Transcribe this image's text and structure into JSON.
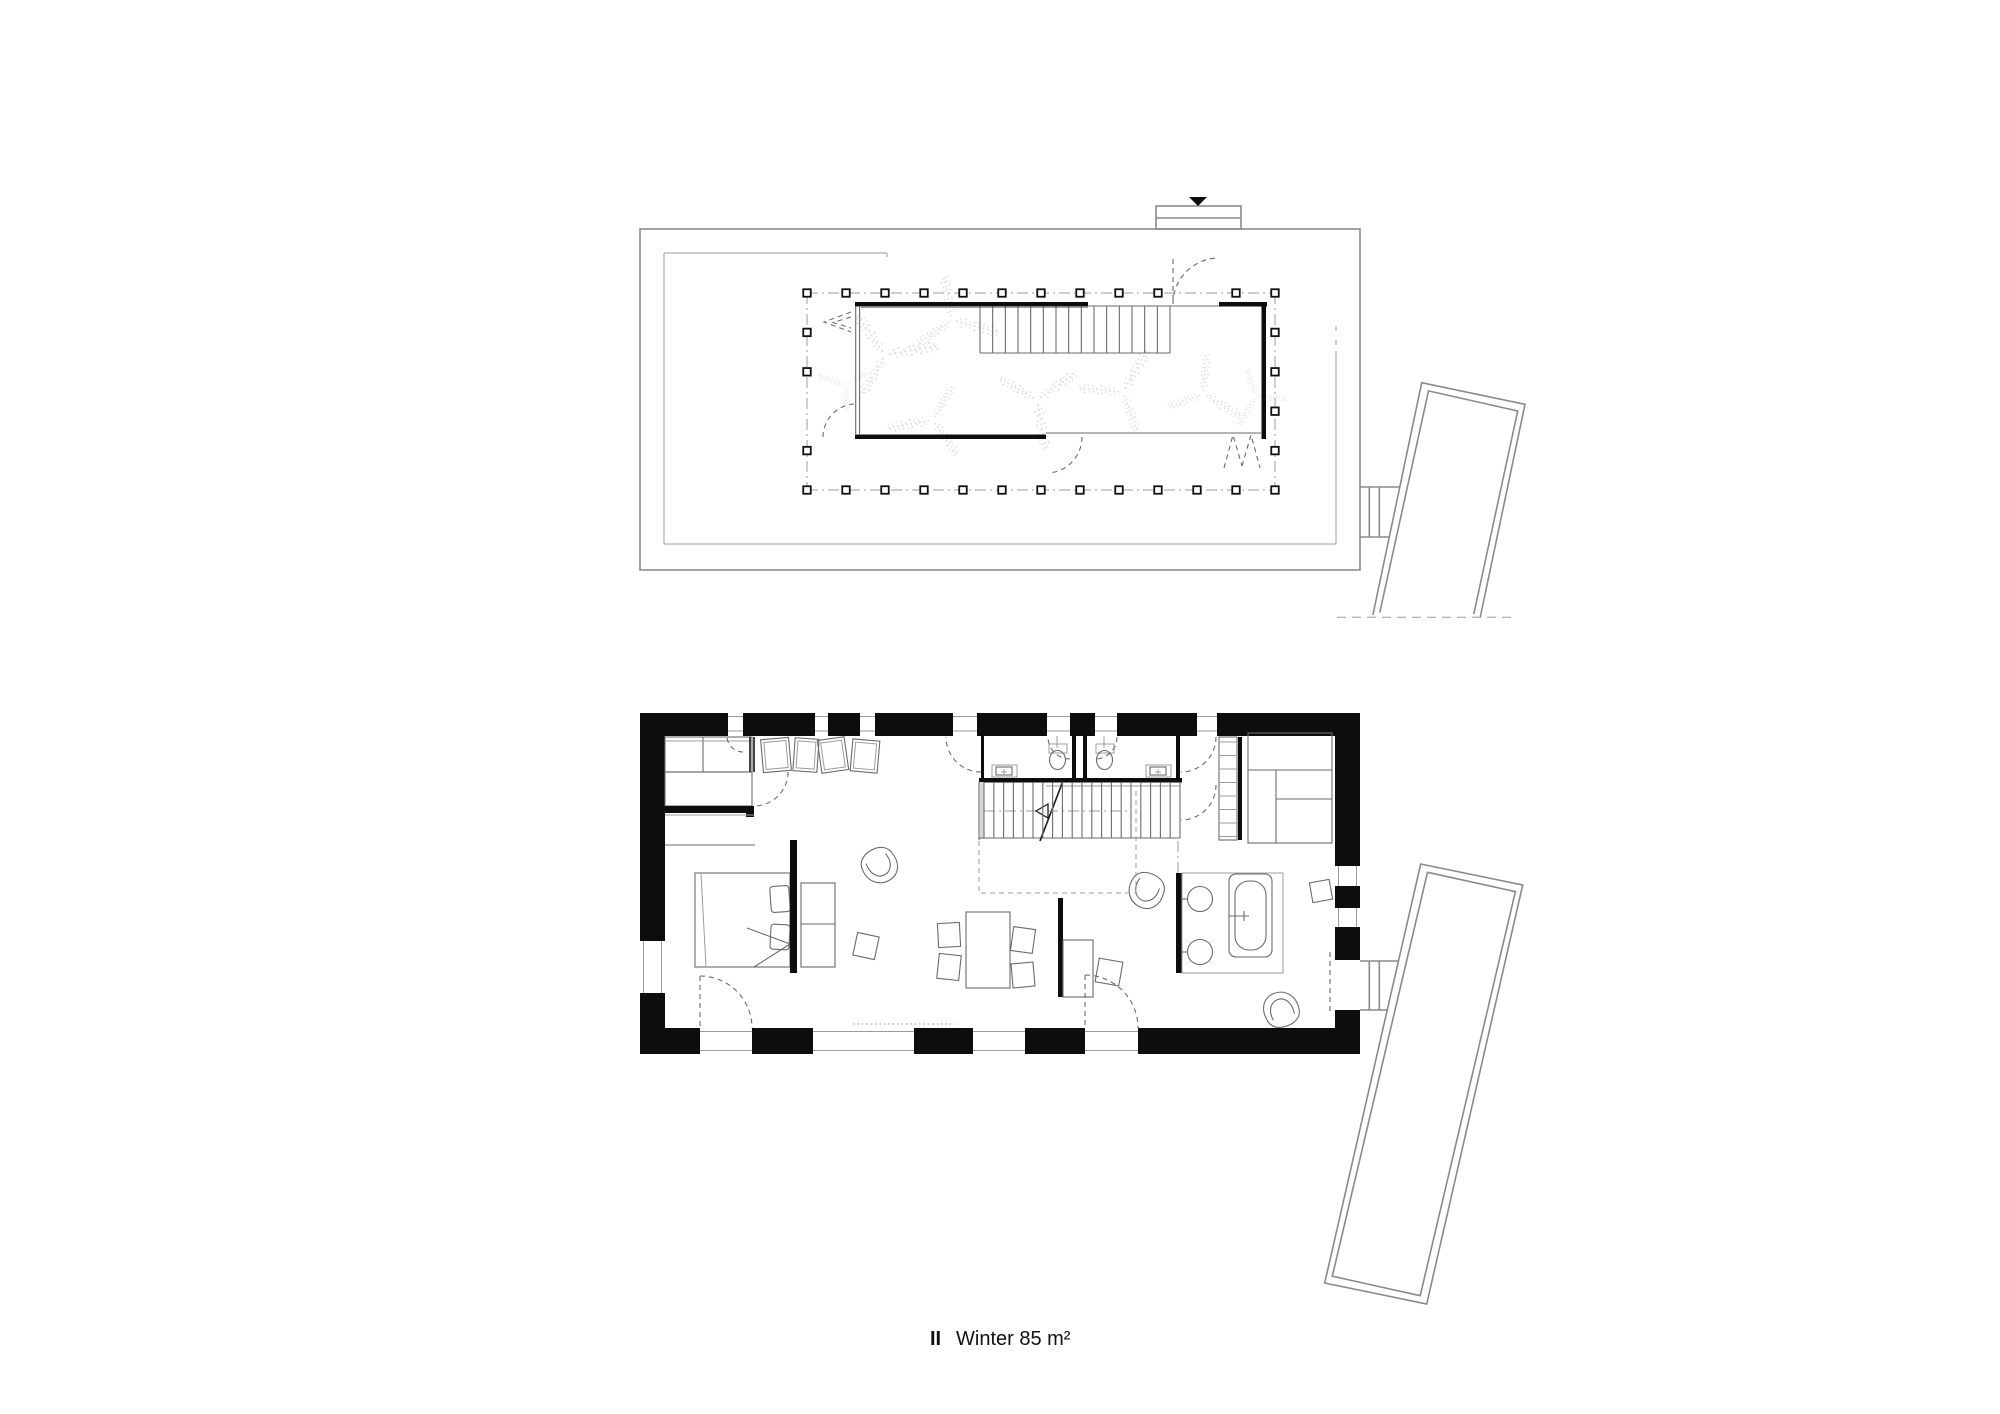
{
  "page": {
    "background": "#ffffff"
  },
  "label": {
    "index": "II",
    "text": "Winter 85 m²",
    "x": 930,
    "y": 1345,
    "text_x": 956,
    "font_size": 20
  },
  "colors": {
    "wall": "#0d0d0d",
    "roof_line": "#8a8a8a",
    "mid_line": "#6b6b6b",
    "light_line": "#9c9c9c",
    "foliage": "#e0e0e0"
  },
  "upper": {
    "outline": [
      640,
      229,
      720,
      341
    ],
    "skylight": {
      "rect": [
        1156,
        206,
        85,
        23
      ],
      "mid_y": 218,
      "tri": "1189,197 1207,197 1198,206"
    },
    "inner_lines": [
      [
        664,
        253,
        887,
        253
      ],
      [
        887,
        253,
        887,
        257
      ],
      [
        664,
        253,
        664,
        544
      ],
      [
        664,
        544,
        1336,
        544
      ],
      [
        1336,
        351,
        1336,
        544
      ]
    ],
    "inner_dashes": [
      [
        1336,
        326,
        1336,
        334
      ],
      [
        1336,
        340,
        1336,
        347
      ]
    ],
    "grid": {
      "x0": 807,
      "dx": 39,
      "nx": 13,
      "y0": 293,
      "dy": 39.4,
      "ny": 6,
      "post": 7.5,
      "skip_top": [
        10
      ],
      "skip_left": [
        3
      ]
    },
    "room": {
      "walls": [
        [
          855,
          302,
          233,
          4.5
        ],
        [
          1219,
          302,
          48,
          4.5
        ],
        [
          1261.5,
          302,
          4.5,
          137
        ],
        [
          855,
          434.5,
          191,
          4.5
        ]
      ],
      "dbl": [
        [
          855.7,
          306,
          855.7,
          434,
          "s-med"
        ],
        [
          859.6,
          306,
          859.6,
          434,
          "s-med"
        ]
      ],
      "thin": [
        [
          861,
          307.5,
          1088,
          307.5,
          "s-light"
        ],
        [
          1088,
          306,
          1219,
          306,
          "s-med"
        ],
        [
          1046,
          433,
          1261,
          433,
          "s-med"
        ]
      ]
    },
    "stairs": {
      "x0": 980,
      "x1": 1170,
      "y0": 306.5,
      "y1": 353,
      "n": 16
    },
    "arcs": [
      [
        1219,
        304,
        46,
        180,
        268
      ],
      [
        1046,
        437,
        36,
        0,
        80
      ],
      [
        856,
        437,
        33,
        180,
        266
      ]
    ],
    "arc_lines": [
      [
        1173,
        259,
        1173,
        302
      ]
    ],
    "zigzags": [
      "851,312 824,322 851,332",
      "851,317 833,322.5 851,328",
      "1224,468 1233,435 1242,466",
      "1242,466 1251,435 1260,468"
    ],
    "ferns": [
      [
        885,
        355,
        1.1,
        -10
      ],
      [
        952,
        320,
        1.0,
        15
      ],
      [
        933,
        420,
        0.95,
        170
      ],
      [
        1037,
        400,
        1.05,
        80
      ],
      [
        1123,
        392,
        1.0,
        -60
      ],
      [
        1203,
        394,
        0.9,
        30
      ],
      [
        1256,
        396,
        0.7,
        120
      ],
      [
        845,
        385,
        0.6,
        200
      ]
    ],
    "connector": [
      [
        1360,
        487,
        1400,
        487
      ],
      [
        1360,
        537,
        1389,
        537
      ],
      [
        1369.3,
        487,
        1369.3,
        537
      ],
      [
        1379.3,
        487,
        1379.3,
        537
      ]
    ],
    "annex_outer": "1372.9,615 1421.7,382.7 1525,404.3 1480.3,617",
    "annex_inner": "1379.8,612.5 1428.5,390.9 1517.7,411 1473.8,614",
    "ground": [
      1337,
      617.3,
      1515,
      617.3
    ]
  },
  "lower": {
    "outer": [
      640,
      713,
      720,
      341
    ],
    "inner": [
      665,
      736,
      670,
      292
    ],
    "gap_rects": [
      [
        728,
        712.5,
        15,
        24
      ],
      [
        815,
        712.5,
        13,
        24
      ],
      [
        860,
        712.5,
        15,
        24
      ],
      [
        953,
        712.5,
        24,
        24
      ],
      [
        1047,
        712.5,
        23,
        24
      ],
      [
        1095,
        712.5,
        22,
        24
      ],
      [
        1197,
        712.5,
        20,
        24
      ],
      [
        639.5,
        941,
        26,
        52
      ],
      [
        1334.5,
        866,
        26,
        20
      ],
      [
        1334.5,
        908,
        26,
        19
      ],
      [
        1334.5,
        960,
        26,
        50
      ],
      [
        700,
        1027.5,
        52,
        27
      ],
      [
        813,
        1027.5,
        101,
        27
      ],
      [
        973,
        1027.5,
        52,
        27
      ],
      [
        1085,
        1027.5,
        53,
        27
      ]
    ],
    "windows_top": [
      [
        728,
        743
      ],
      [
        815,
        828
      ],
      [
        860,
        875
      ],
      [
        953,
        977
      ],
      [
        1047,
        1070
      ],
      [
        1095,
        1117
      ],
      [
        1197,
        1217
      ]
    ],
    "windows_left": [
      [
        941,
        993
      ]
    ],
    "windows_right": [
      [
        866,
        886
      ],
      [
        908,
        927
      ]
    ],
    "windows_bottom": [
      [
        700,
        752
      ],
      [
        813,
        914
      ],
      [
        973,
        1025
      ],
      [
        1085,
        1138
      ]
    ],
    "connector": [
      [
        1360,
        961,
        1398,
        961
      ],
      [
        1360,
        1010,
        1388,
        1010
      ],
      [
        1369.3,
        961,
        1369.3,
        1010
      ],
      [
        1379.3,
        961,
        1379.3,
        1010
      ]
    ],
    "annex_outer": "1420.7,864 1522.7,885 1426.7,1304 1324.7,1283",
    "annex_inner": "1427.5,872.3 1515.4,891.6 1420.2,1295.7 1332.3,1276.2",
    "fixtures": [
      {
        "name": "wardrobe",
        "rects": [
          [
            665,
            737,
            87,
            35,
            "s-med"
          ],
          [
            665,
            772,
            87,
            34,
            "s-med"
          ]
        ],
        "lines": [
          [
            703,
            737,
            703,
            772,
            "s-med"
          ],
          [
            665,
            741,
            752,
            741,
            "s-light"
          ]
        ]
      },
      {
        "name": "interior-walls",
        "blackRects": [
          [
            665,
            806,
            89,
            7
          ],
          [
            746,
            813,
            8,
            4
          ]
        ],
        "lines": [
          [
            750,
            737,
            750,
            772,
            "s-dark"
          ],
          [
            754,
            737,
            754,
            772,
            "s-dark"
          ],
          [
            665,
            815,
            754,
            815,
            "s-light"
          ],
          [
            665,
            845,
            755,
            845,
            "s-med"
          ]
        ]
      },
      {
        "name": "picture-frames",
        "tilted": [
          [
            776,
            755,
            28,
            33,
            -5,
            "s-med",
            1
          ],
          [
            806,
            755,
            24,
            33,
            4,
            "s-med",
            1
          ],
          [
            833,
            755,
            27,
            33,
            -8,
            "s-med",
            1
          ],
          [
            865,
            756,
            27,
            32,
            5,
            "s-med",
            1
          ]
        ]
      },
      {
        "name": "bed",
        "rects": [
          [
            695,
            873,
            95,
            94,
            "s-med"
          ]
        ],
        "lines": [
          [
            701,
            873,
            706,
            967,
            "s-light"
          ],
          [
            747,
            928,
            790,
            944,
            "s-med"
          ],
          [
            790,
            944,
            754,
            967,
            "s-med"
          ]
        ],
        "tilted": [
          [
            780,
            899,
            19,
            26,
            -4,
            "s-med",
            0,
            3
          ],
          [
            780,
            937,
            19,
            25,
            3,
            "s-med",
            0,
            3
          ]
        ]
      },
      {
        "name": "headboard-partition",
        "blackRects": [
          [
            790,
            840,
            7,
            133
          ]
        ]
      },
      {
        "name": "bed-side-shelf",
        "rects": [
          [
            801,
            883,
            34,
            84,
            "s-med"
          ]
        ],
        "lines": [
          [
            801,
            924,
            835,
            924,
            "s-med"
          ]
        ]
      },
      {
        "name": "armchairs",
        "uses": [
          [
            880,
            866,
            -30
          ],
          [
            1146,
            891,
            25
          ],
          [
            1281,
            1009,
            160
          ]
        ]
      },
      {
        "name": "side-tables",
        "tilted": [
          [
            866,
            946,
            22,
            23,
            12,
            "s-med"
          ],
          [
            1321,
            891,
            20,
            20,
            -10,
            "s-med"
          ]
        ]
      },
      {
        "name": "dining-set",
        "rects": [
          [
            966,
            912,
            44,
            76,
            "s-med"
          ]
        ],
        "tilted": [
          [
            949,
            935,
            22,
            24,
            -3,
            "s-med"
          ],
          [
            949,
            967,
            22,
            25,
            6,
            "s-med"
          ],
          [
            1023,
            940,
            22,
            24,
            8,
            "s-med"
          ],
          [
            1023,
            975,
            22,
            24,
            -5,
            "s-med"
          ]
        ]
      },
      {
        "name": "desk-partition",
        "blackRects": [
          [
            1058,
            898,
            5,
            99
          ]
        ],
        "rects": [
          [
            1063,
            940,
            30,
            57,
            "s-med"
          ]
        ],
        "tilted": [
          [
            1109,
            972,
            24,
            24,
            10,
            "s-med"
          ]
        ]
      },
      {
        "name": "bathrooms",
        "blackRects": [
          [
            981,
            736,
            3,
            46
          ],
          [
            1072,
            736,
            4,
            46
          ],
          [
            1083,
            736,
            4,
            46
          ],
          [
            1176,
            736,
            4,
            46
          ],
          [
            979,
            778,
            203,
            4.5
          ]
        ],
        "rects": [
          [
            1049,
            744,
            18,
            9,
            "s-light"
          ],
          [
            1096,
            744,
            18,
            9,
            "s-light"
          ],
          [
            992,
            765,
            25,
            12,
            "s-light"
          ],
          [
            1146,
            765,
            25,
            12,
            "s-light"
          ],
          [
            996,
            767,
            16,
            8,
            "s-med"
          ],
          [
            1150,
            767,
            16,
            8,
            "s-med"
          ]
        ],
        "ellipses": [
          [
            1057.5,
            760,
            8,
            9.5,
            "s-med"
          ],
          [
            1104.5,
            760,
            8,
            9.5,
            "s-med"
          ]
        ],
        "lines": [
          [
            1057,
            736,
            1057,
            748,
            "s-light"
          ],
          [
            1104,
            736,
            1104,
            748,
            "s-light"
          ],
          [
            1004,
            769,
            1004,
            775,
            "s-light"
          ],
          [
            1001,
            772,
            1007,
            772,
            "s-light"
          ],
          [
            1158,
            769,
            1158,
            775,
            "s-light"
          ],
          [
            1155,
            772,
            1161,
            772,
            "s-light"
          ]
        ]
      },
      {
        "name": "staircase",
        "grayRects": [
          [
            980,
            782,
            4,
            57
          ]
        ],
        "stairs": {
          "x0": 984,
          "x1": 1180,
          "y0": 782,
          "y1": 838,
          "n": 21
        },
        "lines": [
          [
            1046,
            786,
            1180,
            786,
            "s-light"
          ],
          [
            979,
            838,
            1180,
            838,
            "s-med"
          ],
          [
            979,
            782,
            979,
            840,
            "s-med"
          ],
          [
            1040,
            841,
            1063,
            781,
            "s-dark"
          ]
        ],
        "dashDotLines": [
          [
            984,
            811,
            1128,
            811
          ],
          [
            1178,
            841,
            1178,
            874
          ]
        ],
        "polylines": [
          {
            "p": "979,841 979,893 1136,893 1136,787",
            "c": "s-light dash"
          }
        ],
        "paths": [
          {
            "d": "M1048 804 L1036 811 L1048 818 Z",
            "c": "arrow"
          }
        ]
      },
      {
        "name": "kitchen-shelves",
        "rects": [
          [
            1219,
            737,
            18,
            103,
            "s-med"
          ],
          [
            1248,
            733,
            84,
            110,
            "s-med"
          ]
        ],
        "blackRects": [
          [
            1238,
            737,
            4,
            103
          ]
        ],
        "rungs": {
          "x0": 1219,
          "x1": 1237,
          "y0": 742,
          "dy": 13.5,
          "n": 8
        },
        "lines": [
          [
            1248,
            770,
            1332,
            770,
            "s-med"
          ],
          [
            1276,
            770,
            1276,
            843,
            "s-med"
          ],
          [
            1276,
            799,
            1332,
            799,
            "s-med"
          ]
        ]
      },
      {
        "name": "kitchen-island-bathtub",
        "blackRects": [
          [
            1176,
            873,
            6,
            100
          ]
        ],
        "rects": [
          [
            1182,
            873,
            101,
            100,
            "s-light"
          ],
          [
            1229,
            874,
            43,
            83,
            "s-med",
            7
          ],
          [
            1235,
            881,
            31,
            69,
            "s-med",
            14
          ]
        ],
        "circles": [
          [
            1200,
            899,
            12.5,
            "s-med"
          ],
          [
            1200,
            952,
            12.5,
            "s-med"
          ]
        ],
        "lines": [
          [
            1182,
            899,
            1188,
            899,
            "s-med"
          ],
          [
            1182,
            952,
            1188,
            952,
            "s-med"
          ],
          [
            1229,
            916,
            1249,
            916,
            "s-med"
          ],
          [
            1244,
            911,
            1244,
            921,
            "s-med"
          ]
        ]
      },
      {
        "name": "door-swing-arcs",
        "arcs": [
          [
            754,
            772,
            34,
            0,
            90
          ],
          [
            743,
            736,
            16,
            90,
            180
          ],
          [
            981,
            737,
            35,
            90,
            180
          ],
          [
            1181,
            737,
            35,
            0,
            90
          ],
          [
            1070,
            737,
            22,
            90,
            180
          ],
          [
            1095,
            737,
            22,
            0,
            90
          ],
          [
            1181,
            785,
            35,
            0,
            90
          ],
          [
            700,
            1028,
            52,
            270,
            360
          ],
          [
            1085,
            1028,
            53,
            270,
            360
          ]
        ],
        "dashLines": [
          [
            700,
            976,
            700,
            1028
          ],
          [
            1085,
            975,
            1085,
            1028
          ]
        ]
      },
      {
        "name": "floor-marks",
        "dotLines": [
          [
            853,
            1024,
            955,
            1024
          ]
        ],
        "dashLines": [
          [
            1330,
            952,
            1330,
            1012
          ]
        ]
      }
    ]
  }
}
